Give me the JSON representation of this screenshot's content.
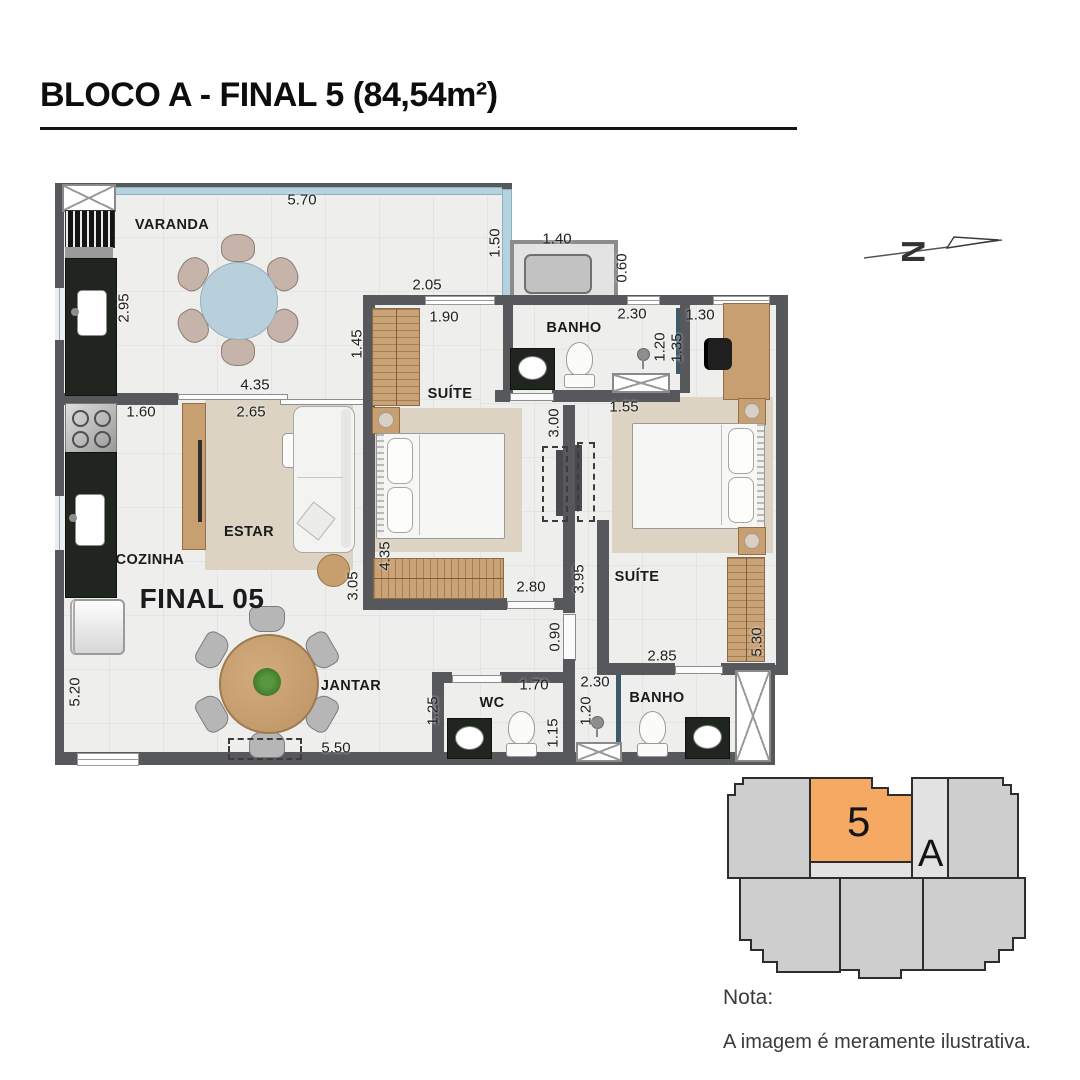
{
  "title": "BLOCO A - FINAL 5 (84,54m²)",
  "rooms": {
    "varanda": "VARANDA",
    "suite1": "SUÍTE",
    "banho1": "BANHO",
    "estar": "ESTAR",
    "cozinha": "COZINHA",
    "jantar": "JANTAR",
    "suite2": "SUÍTE",
    "wc": "WC",
    "banho2": "BANHO"
  },
  "unit_label": "FINAL 05",
  "dims": [
    {
      "v": "5.70"
    },
    {
      "v": "1.40"
    },
    {
      "v": "0.60"
    },
    {
      "v": "1.50"
    },
    {
      "v": "2.95"
    },
    {
      "v": "2.05"
    },
    {
      "v": "1.90"
    },
    {
      "v": "2.30"
    },
    {
      "v": "1.20"
    },
    {
      "v": "1.30"
    },
    {
      "v": "1.35"
    },
    {
      "v": "1.45"
    },
    {
      "v": "4.35"
    },
    {
      "v": "1.60"
    },
    {
      "v": "2.65"
    },
    {
      "v": "1.55"
    },
    {
      "v": "3.00"
    },
    {
      "v": "4.35"
    },
    {
      "v": "3.05"
    },
    {
      "v": "2.80"
    },
    {
      "v": "3.95"
    },
    {
      "v": "0.90"
    },
    {
      "v": "5.30"
    },
    {
      "v": "2.85"
    },
    {
      "v": "5.20"
    },
    {
      "v": "1.25"
    },
    {
      "v": "1.70"
    },
    {
      "v": "1.15"
    },
    {
      "v": "2.30"
    },
    {
      "v": "1.20"
    },
    {
      "v": "5.50"
    }
  ],
  "north": {
    "label": "N"
  },
  "keyplan": {
    "unit_number": "5",
    "block_letter": "A"
  },
  "note": {
    "heading": "Nota:",
    "body": "A imagem é meramente ilustrativa."
  }
}
